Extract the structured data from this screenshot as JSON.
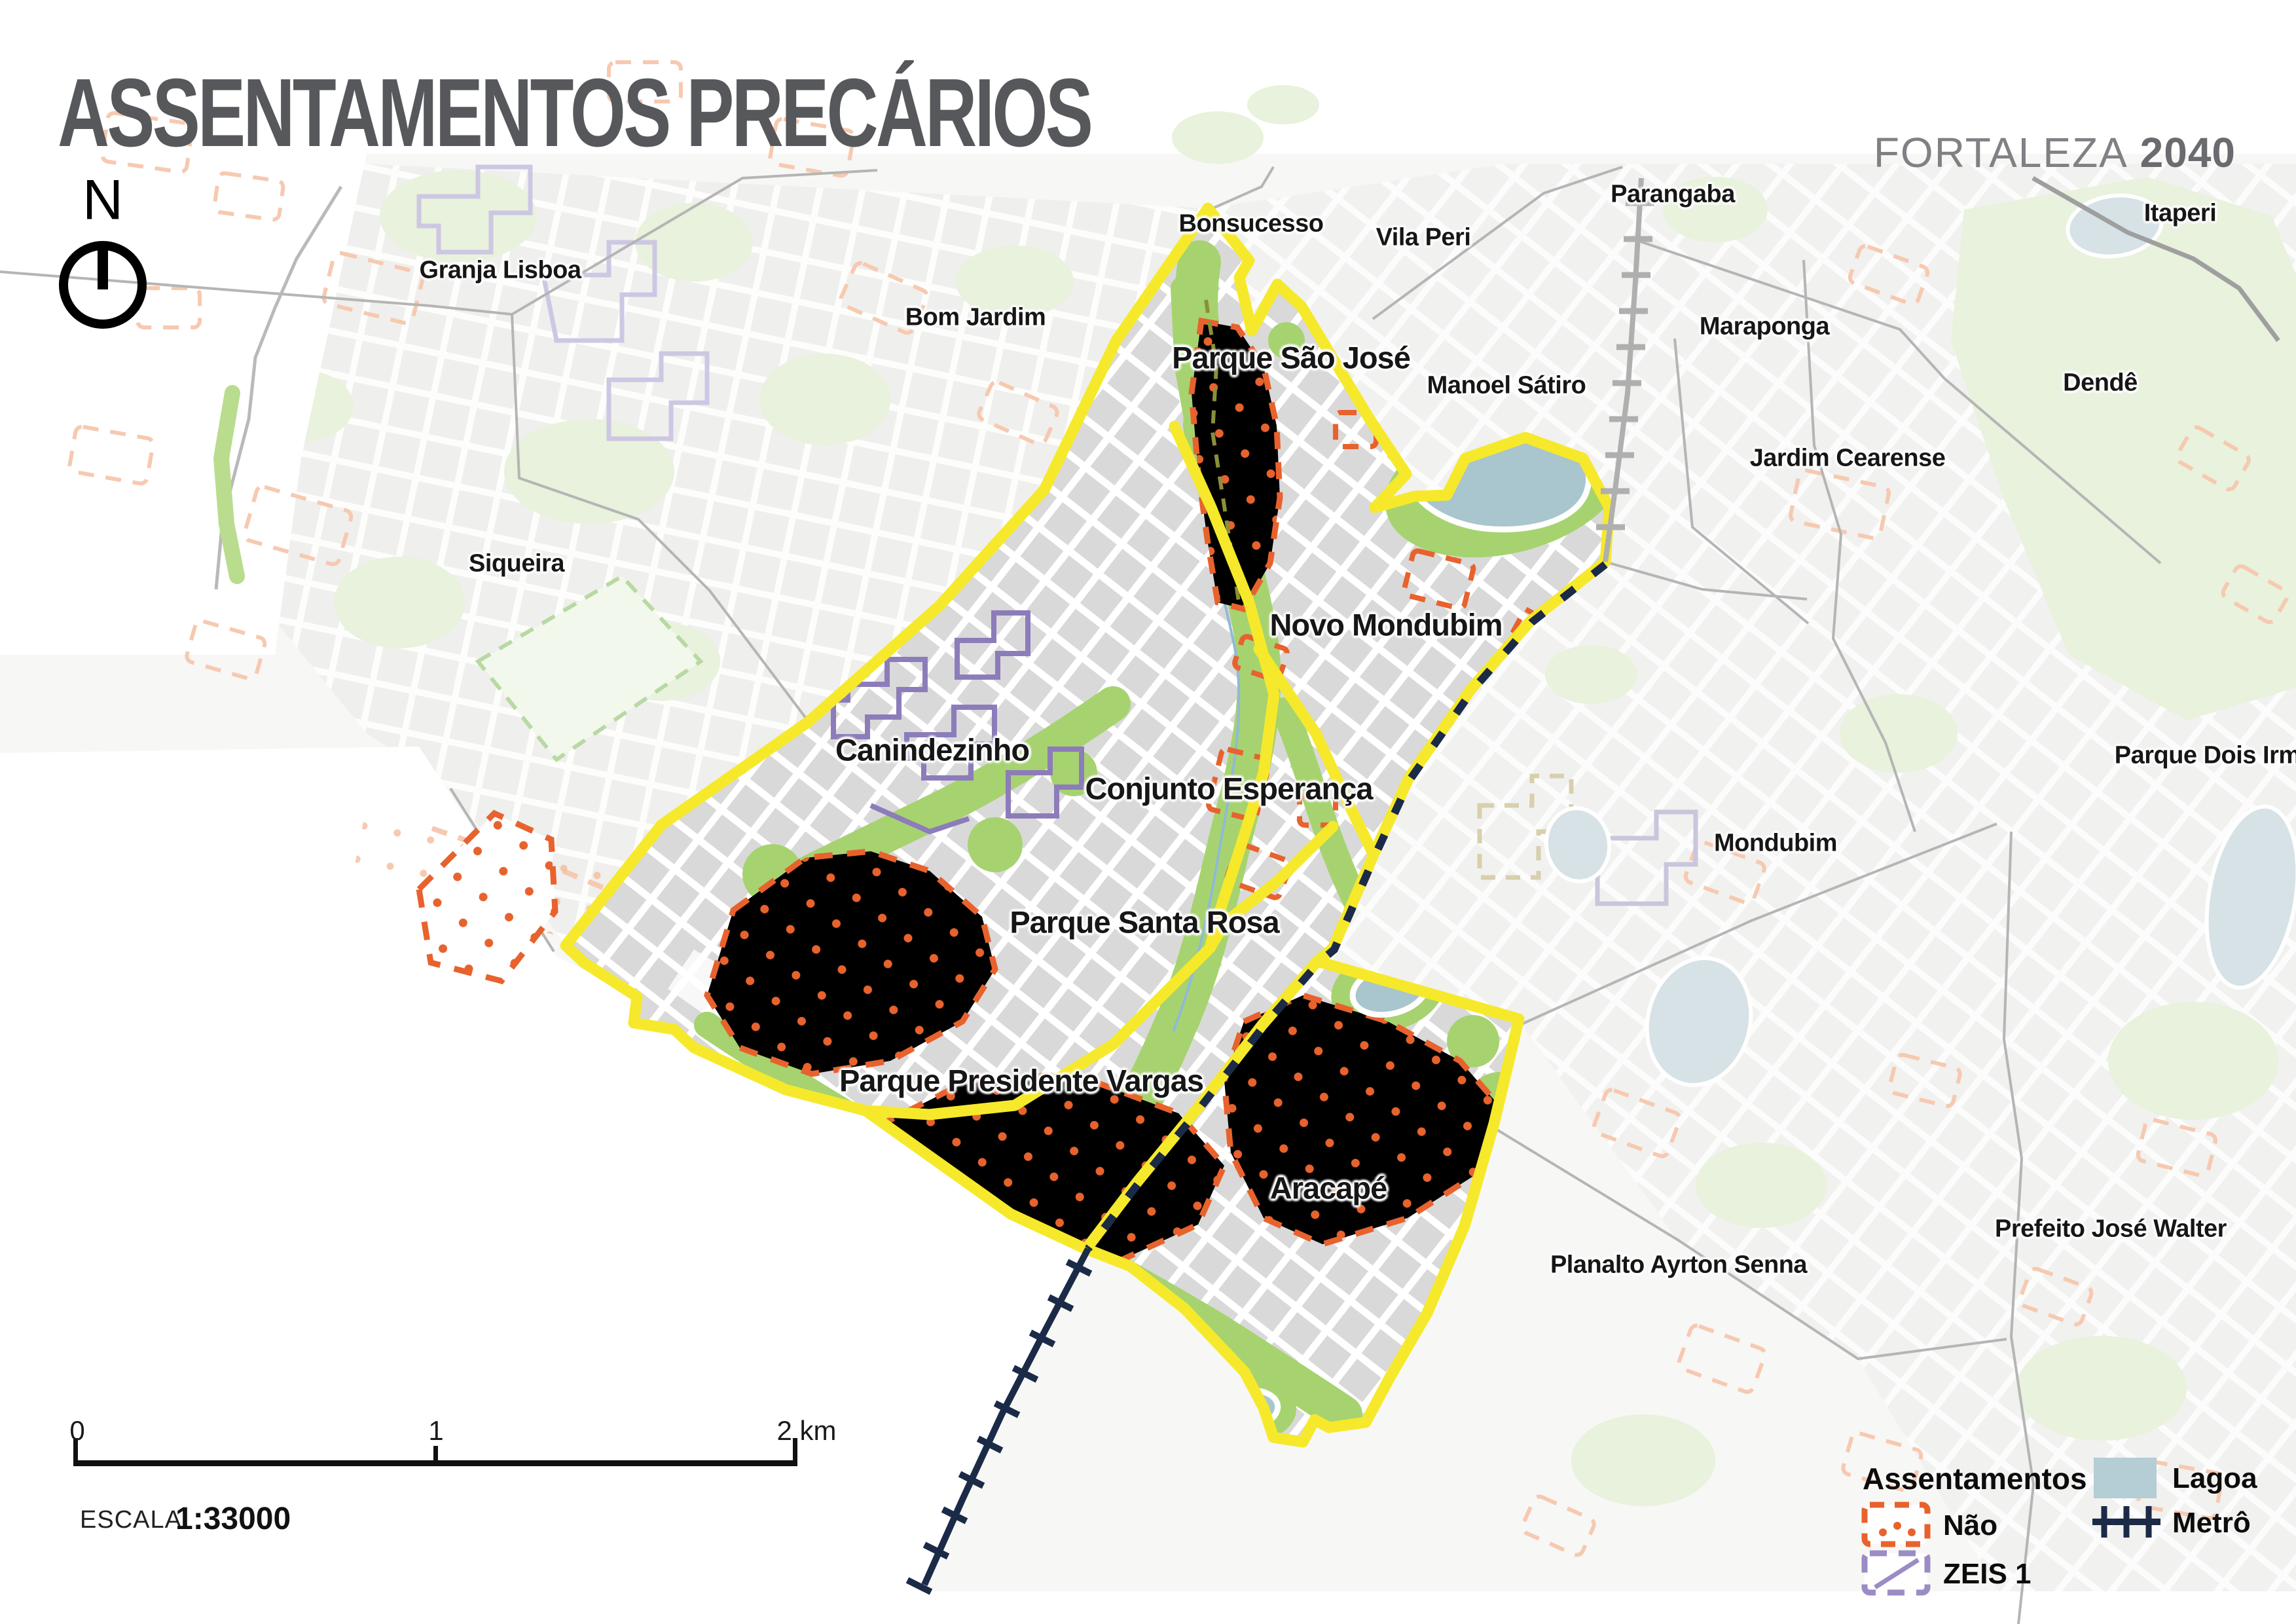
{
  "title": "ASSENTAMENTOS PRECÁRIOS",
  "brand": {
    "city": "FORTALEZA",
    "year": "2040"
  },
  "compass": {
    "label": "N"
  },
  "map_labels": [
    {
      "id": "granja-lisboa",
      "text": "Granja Lisboa",
      "inside": false
    },
    {
      "id": "bom-jardim",
      "text": "Bom Jardim",
      "inside": false
    },
    {
      "id": "bonsucesso",
      "text": "Bonsucesso",
      "inside": false
    },
    {
      "id": "vila-peri",
      "text": "Vila Peri",
      "inside": false
    },
    {
      "id": "parangaba",
      "text": "Parangaba",
      "inside": false
    },
    {
      "id": "itaperi",
      "text": "Itaperi",
      "inside": false
    },
    {
      "id": "maraponga",
      "text": "Maraponga",
      "inside": false
    },
    {
      "id": "manoel-satiro",
      "text": "Manoel Sátiro",
      "inside": false
    },
    {
      "id": "dende",
      "text": "Dendê",
      "inside": false
    },
    {
      "id": "jardim-cearense",
      "text": "Jardim Cearense",
      "inside": false
    },
    {
      "id": "parque-sao-jose",
      "text": "Parque São José",
      "inside": true
    },
    {
      "id": "novo-mondubim",
      "text": "Novo Mondubim",
      "inside": true
    },
    {
      "id": "siqueira",
      "text": "Siqueira",
      "inside": false
    },
    {
      "id": "canindezinho",
      "text": "Canindezinho",
      "inside": true
    },
    {
      "id": "conjunto-esperanca",
      "text": "Conjunto Esperança",
      "inside": true
    },
    {
      "id": "parque-santa-rosa",
      "text": "Parque Santa Rosa",
      "inside": true
    },
    {
      "id": "parque-dois-irma",
      "text": "Parque Dois Irmã",
      "inside": false
    },
    {
      "id": "mondubim",
      "text": "Mondubim",
      "inside": false
    },
    {
      "id": "parque-presidente-vargas",
      "text": "Parque Presidente Vargas",
      "inside": true
    },
    {
      "id": "aracape",
      "text": "Aracapé",
      "inside": true
    },
    {
      "id": "planalto-ayrton-senna",
      "text": "Planalto Ayrton Senna",
      "inside": false
    },
    {
      "id": "prefeito-jose-walter",
      "text": "Prefeito José Walter",
      "inside": false
    }
  ],
  "legend": {
    "header": "Assentamentos",
    "items_left": [
      {
        "label": "Não",
        "swatch": "orange-dashed-dots"
      },
      {
        "label": "ZEIS 1",
        "swatch": "purple-dashed-diagonal"
      }
    ],
    "items_right": [
      {
        "label": "Lagoa",
        "swatch": "blue-fill"
      },
      {
        "label": "Metrô",
        "swatch": "navy-rail-line"
      }
    ]
  },
  "scalebar": {
    "tick0": "0",
    "tick1": "1",
    "tick2": "2 km",
    "escala_label": "ESCALA",
    "ratio": "1:33000"
  },
  "colors": {
    "boundary_yellow": "#F6E92B",
    "settlement_orange": "#E8622D",
    "settlement_orange_pale": "#F6C9B0",
    "zeis_purple": "#8D7CBA",
    "zeis_purple_pale": "#CDC7E3",
    "green_corridor": "#A6D36F",
    "lagoon": "#A9C5CD",
    "lagoon_pale": "#D7E2E6",
    "metro_navy": "#1B2A47",
    "rail_gray": "#AFAFAF",
    "block_gray": "#D9D9D9",
    "title_gray": "#57585B"
  }
}
